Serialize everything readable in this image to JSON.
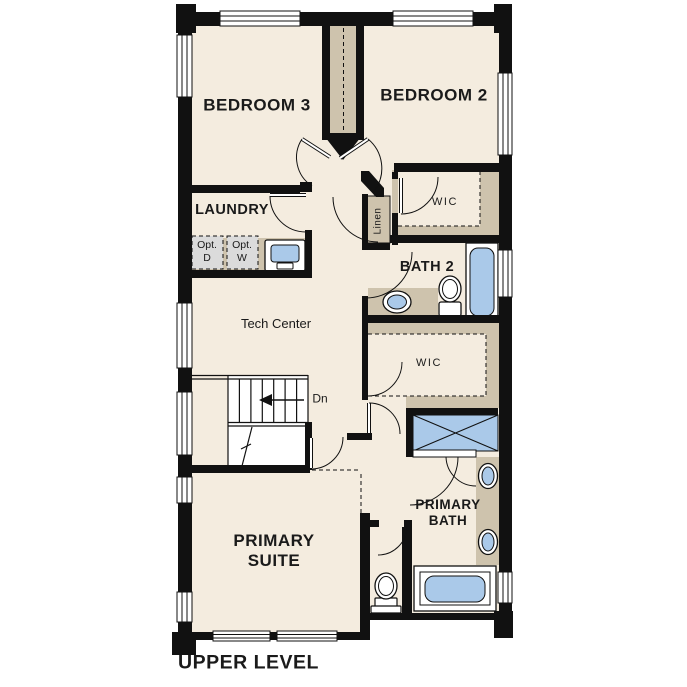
{
  "title": "UPPER LEVEL",
  "labels": {
    "bedroom3": "BEDROOM 3",
    "bedroom2": "BEDROOM 2",
    "laundry": "LAUNDRY",
    "opt_d_1": "Opt.",
    "opt_d_2": "D",
    "opt_w_1": "Opt.",
    "opt_w_2": "W",
    "linen": "Linen",
    "wic_upper": "WIC",
    "bath2": "BATH 2",
    "tech_center": "Tech Center",
    "stairs_down": "Dn",
    "wic_lower": "WIC",
    "primary_bath_1": "PRIMARY",
    "primary_bath_2": "BATH",
    "primary_suite_1": "PRIMARY",
    "primary_suite_2": "SUITE"
  },
  "colors": {
    "wall": "#111111",
    "floor": "#f4ecdf",
    "casework_tan": "#cec3ad",
    "fixture_blue": "#aac9e9",
    "optional_gray": "#dbdbdb",
    "background": "#ffffff"
  },
  "fixtures": [
    "optional-dryer",
    "optional-washer",
    "laundry-sink",
    "linen-closet",
    "bath2-sink",
    "bath2-toilet",
    "bath2-bathtub",
    "walk-in-closet-upper",
    "walk-in-closet-lower",
    "shower",
    "primary-vanity-sink-1",
    "primary-vanity-sink-2",
    "primary-toilet",
    "primary-bathtub",
    "stairs-down"
  ]
}
